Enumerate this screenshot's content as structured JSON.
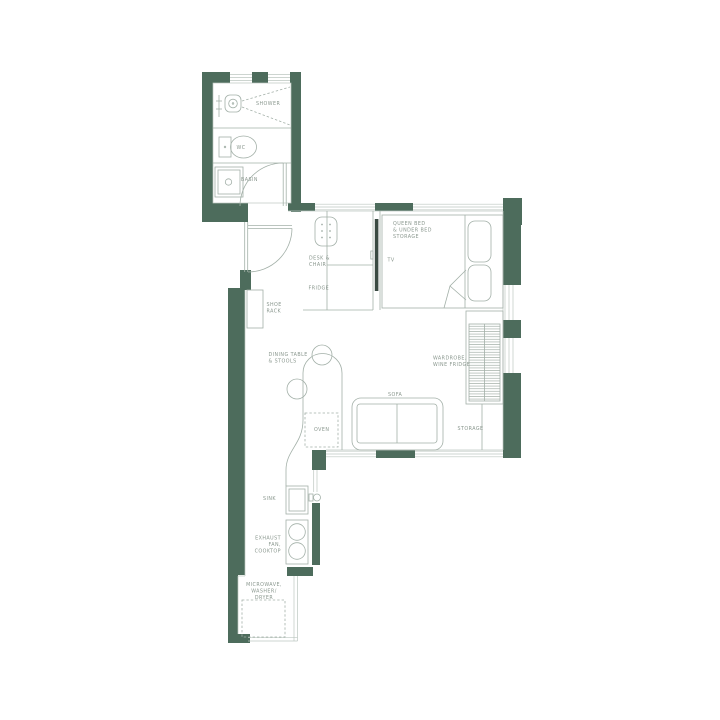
{
  "floorplan": {
    "bathroom": {
      "shower_label": "SHOWER",
      "wc_label": "WC",
      "basin_label": "BASIN"
    },
    "entry": {
      "shoe_rack_label": [
        "SHOE",
        "RACK"
      ]
    },
    "bedroom": {
      "bed_label": [
        "QUEEN BED",
        "& UNDER BED",
        "STORAGE"
      ],
      "tv_label": "TV",
      "desk_label": [
        "DESK &",
        "CHAIR"
      ],
      "fridge_label": "FRIDGE"
    },
    "living": {
      "sofa_label": "SOFA",
      "dining_label": [
        "DINING TABLE",
        "& STOOLS"
      ],
      "wardrobe_label": [
        "WARDROBE,",
        "WINE FRIDGE"
      ],
      "storage_label": "STORAGE"
    },
    "kitchen": {
      "oven_label": "OVEN",
      "sink_label": "SINK",
      "cooktop_label": [
        "EXHAUST",
        "FAN,",
        "COOKTOP"
      ],
      "microwave_label": [
        "MICROWAVE,",
        "WASHER/",
        "DRYER"
      ]
    },
    "colors": {
      "wall": "#4d6c5c",
      "line": "#a3b0a8",
      "text": "#8a978e",
      "tv": "#3a4a42",
      "window": "#bcc7c0",
      "background": "#ffffff"
    }
  }
}
